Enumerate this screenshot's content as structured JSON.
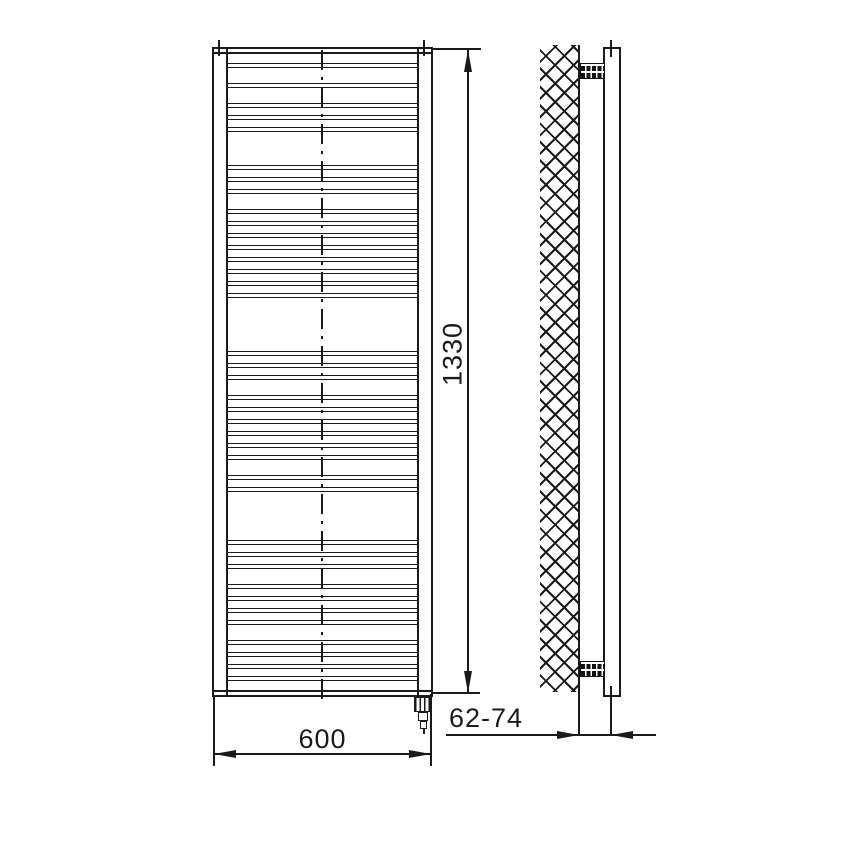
{
  "drawing": {
    "description": "Technical dimension drawing of a ladder-style electric towel rail radiator: front view and wall-mounted side view",
    "colors": {
      "line": "#1a1a1a",
      "background": "#ffffff"
    },
    "dimensions": {
      "width": {
        "label": "600"
      },
      "height": {
        "label": "1330"
      },
      "wall_distance": {
        "label": "62-74"
      }
    },
    "front_view": {
      "name": "front-view",
      "top_header_y": 47,
      "bottom_header_y": 690,
      "rung_lines_y": [
        65,
        85,
        105,
        117,
        129,
        167,
        179,
        191,
        211,
        223,
        235,
        247,
        259,
        271,
        283,
        295,
        353,
        365,
        377,
        397,
        409,
        421,
        433,
        445,
        457,
        477,
        489,
        542,
        554,
        566,
        586,
        598,
        610,
        622,
        642,
        654,
        666,
        678
      ],
      "has_centerline": true,
      "heating_element": "electric heating cartridge with plug at bottom right"
    },
    "side_view": {
      "name": "side-view",
      "wall": "cross-hatched wall section",
      "brackets": [
        "top mounting bracket",
        "bottom mounting bracket"
      ]
    }
  }
}
